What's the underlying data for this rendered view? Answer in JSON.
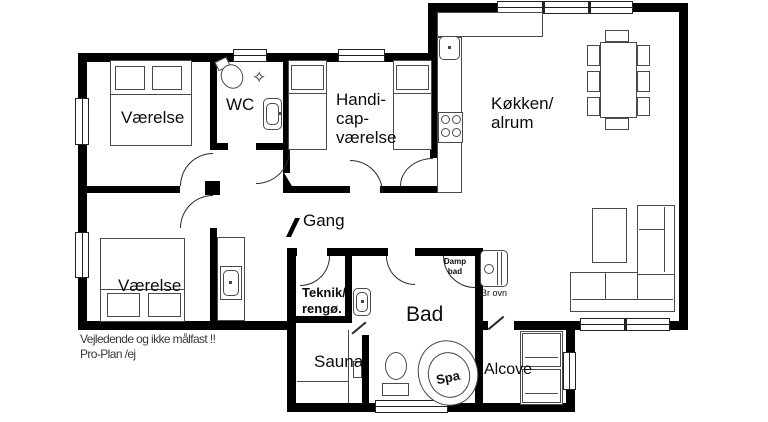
{
  "plan": {
    "labels": {
      "bedroom1": "Værelse",
      "bedroom2": "Værelse",
      "wc": "WC",
      "handicap1": "Handi-",
      "handicap2": "cap-",
      "handicap3": "værelse",
      "kitchen1": "Køkken/",
      "kitchen2": "alrum",
      "hallway": "Gang",
      "tech1": "Teknik/",
      "tech2": "rengø.",
      "bath": "Bad",
      "steam1": "Damp",
      "steam2": "bad",
      "wood_stove": "Br ovn",
      "sauna": "Sauna",
      "spa": "Spa",
      "alcove": "Alcove"
    },
    "symbols": {
      "sparkle": "✧"
    },
    "footnote1": "Vejledende og ikke målfast !!",
    "footnote2": "Pro-Plan /ej",
    "colors": {
      "wall": "#000000",
      "floor": "#ffffff",
      "furniture_line": "#4a4a4a",
      "note_text": "#3a3a3a"
    }
  }
}
